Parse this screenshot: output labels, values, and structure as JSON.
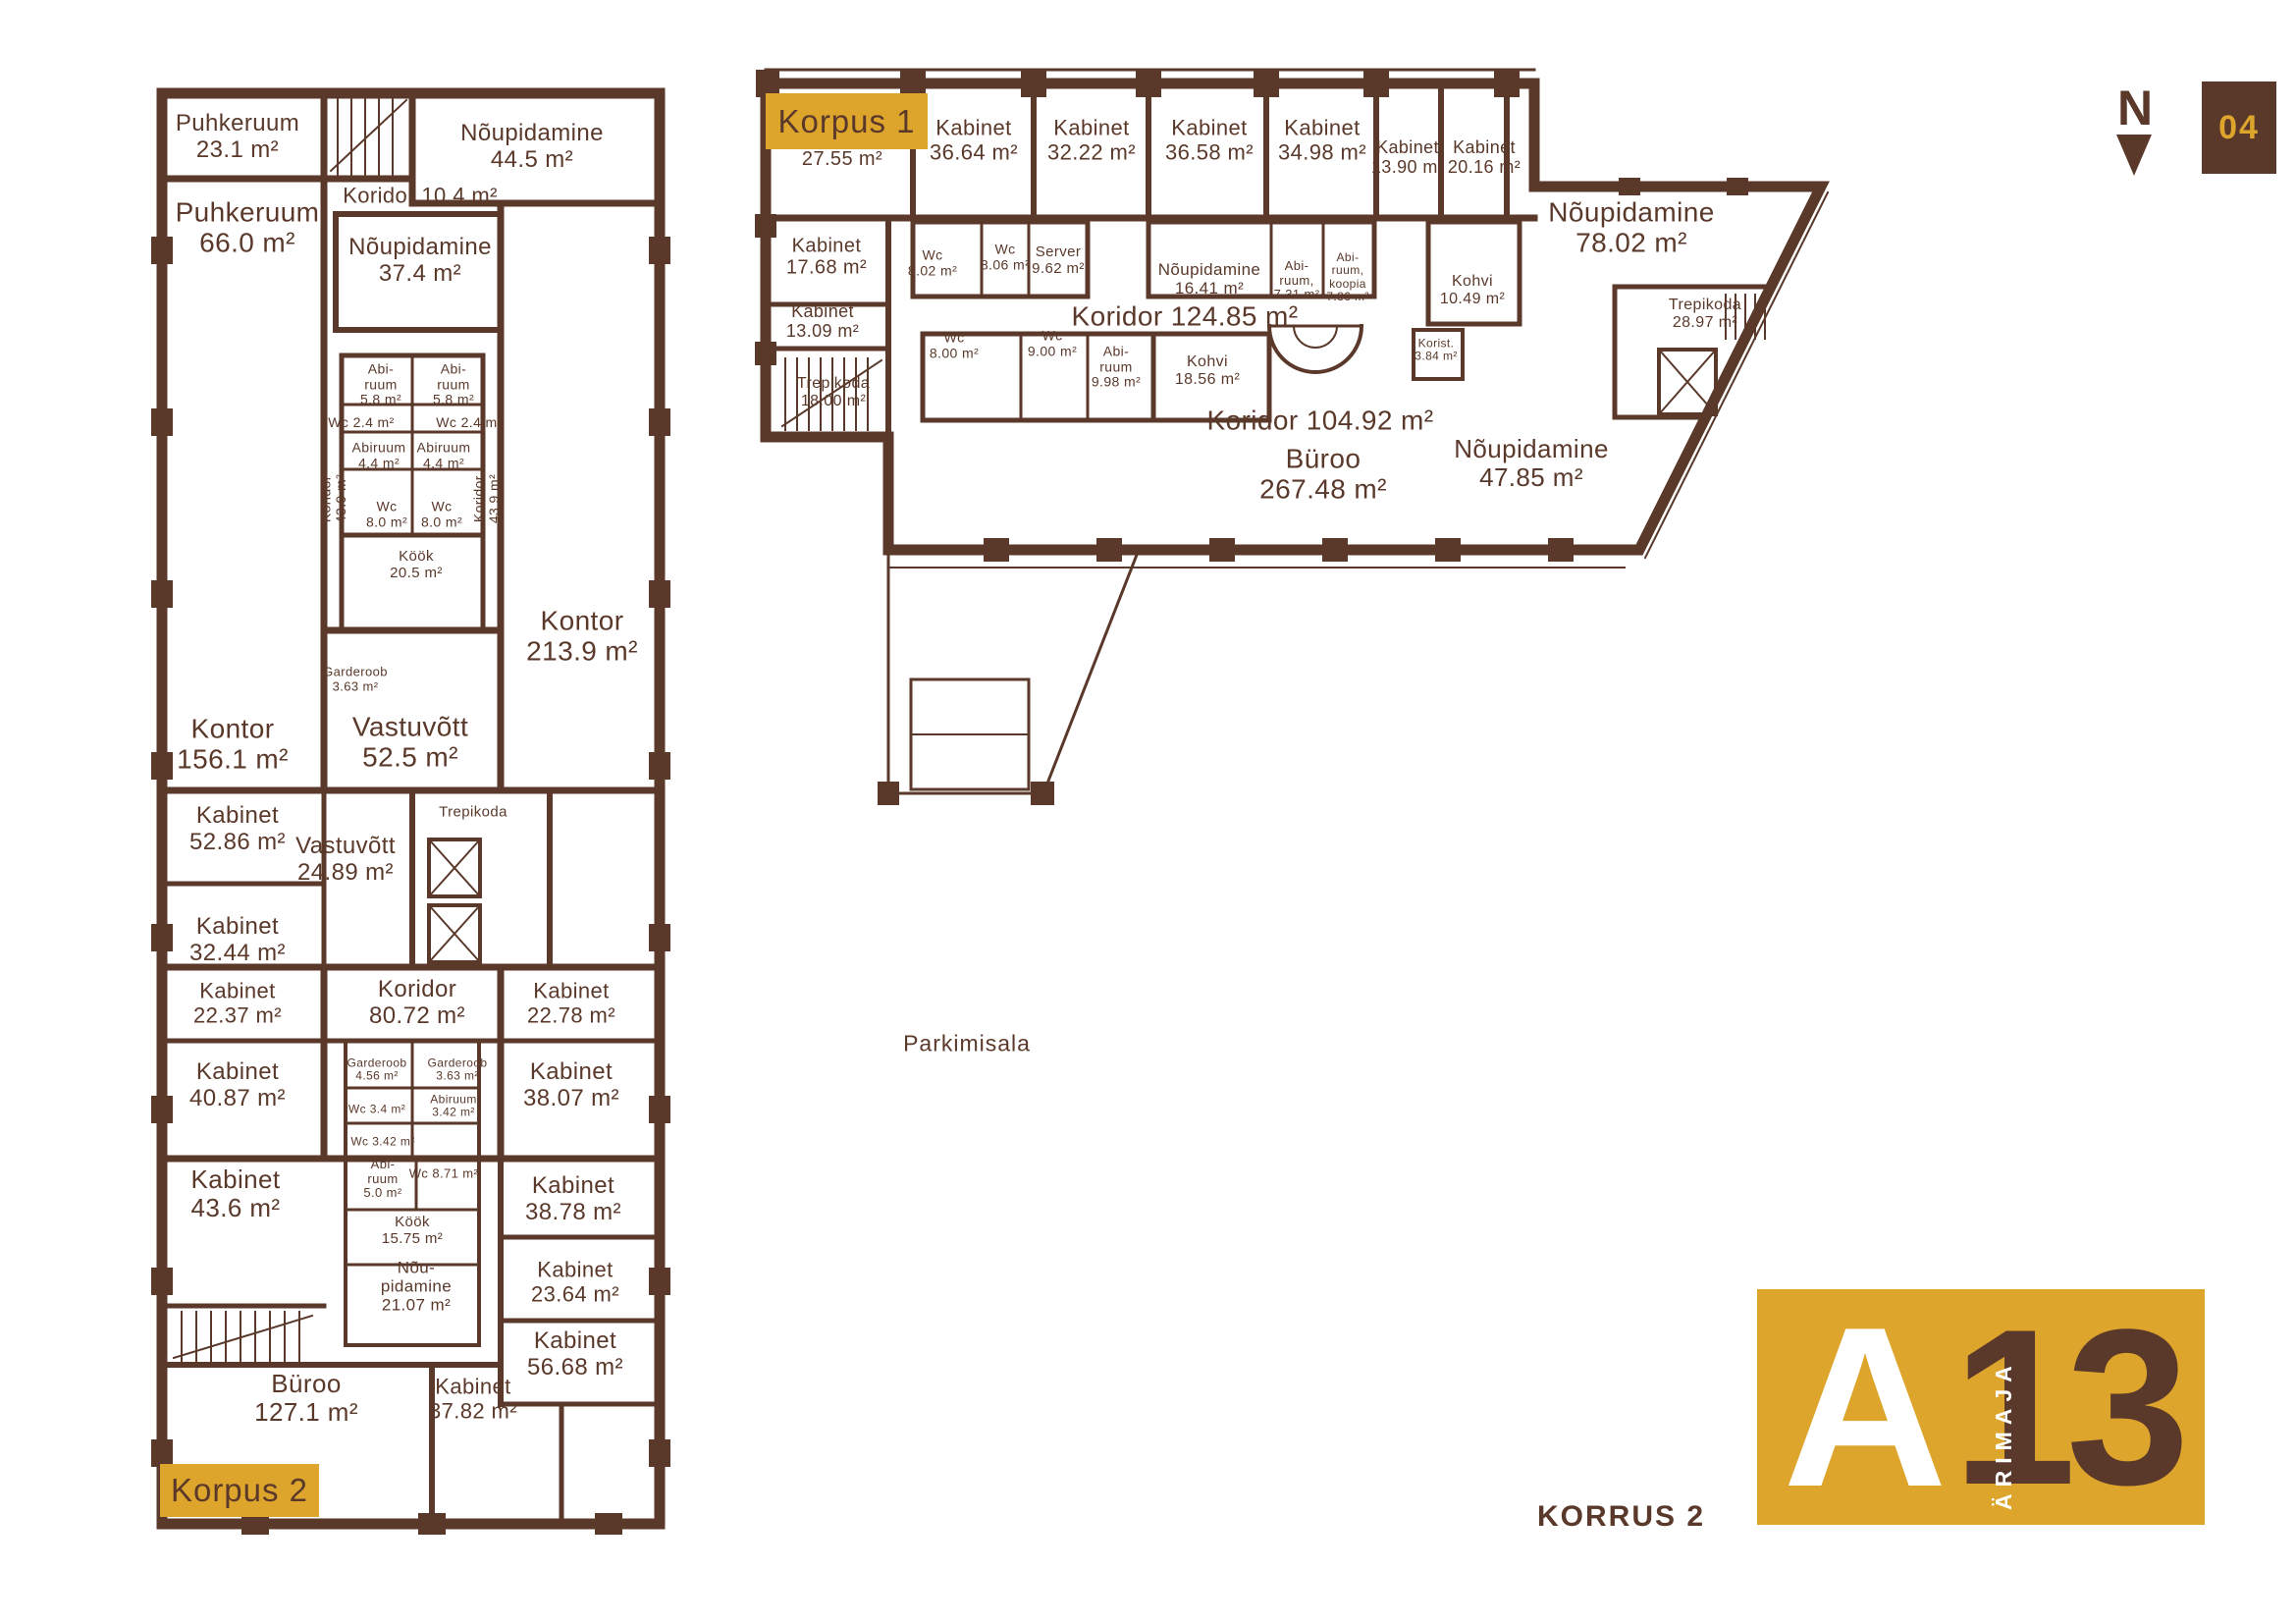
{
  "colors": {
    "brown": "#5A392B",
    "gold": "#DEA52C",
    "white": "#ffffff"
  },
  "header": {
    "compass_letter": "N",
    "sheet_number": "04"
  },
  "footer": {
    "floor_label": "KORRUS 2"
  },
  "site": {
    "parking_label": "Parkimisala"
  },
  "logo": {
    "letter_a": "A",
    "number": "13",
    "vertical_text": "ÄRIMAJA"
  },
  "korpus1": {
    "tag": "Korpus 1",
    "rooms": [
      {
        "name": "",
        "area": "27.55 m²"
      },
      {
        "name": "Kabinet",
        "area": "36.64 m²"
      },
      {
        "name": "Kabinet",
        "area": "32.22 m²"
      },
      {
        "name": "Kabinet",
        "area": "36.58 m²"
      },
      {
        "name": "Kabinet",
        "area": "34.98 m²"
      },
      {
        "name": "Kabinet",
        "area": "13.90 m²"
      },
      {
        "name": "Kabinet",
        "area": "20.16 m²"
      },
      {
        "name": "Nõupidamine",
        "area": "78.02 m²"
      },
      {
        "name": "Kabinet",
        "area": "17.68 m²"
      },
      {
        "name": "Wc",
        "area": "8.02 m²"
      },
      {
        "name": "Wc",
        "area": "8.06 m²"
      },
      {
        "name": "Server",
        "area": "9.62 m²"
      },
      {
        "name": "Nõupidamine",
        "area": "16.41 m²"
      },
      {
        "name": "Abi-\nruum,",
        "area": "7.31 m²"
      },
      {
        "name": "Abi-\nruum,\nkoopia",
        "area": "7.86 m²"
      },
      {
        "name": "Kohvi",
        "area": "10.49 m²"
      },
      {
        "name": "Trepikoda",
        "area": "28.97 m²"
      },
      {
        "name": "Koridor",
        "area": "124.85 m²"
      },
      {
        "name": "Kabinet",
        "area": "13.09 m²"
      },
      {
        "name": "Trepikoda",
        "area": "18.00 m²"
      },
      {
        "name": "Wc",
        "area": "8.00 m²"
      },
      {
        "name": "Wc",
        "area": "9.00 m²"
      },
      {
        "name": "Abi-\nruum",
        "area": "9.98 m²"
      },
      {
        "name": "Kohvi",
        "area": "18.56 m²"
      },
      {
        "name": "Korist.",
        "area": "3.84 m²"
      },
      {
        "name": "Koridor",
        "area": "104.92 m²"
      },
      {
        "name": "Büroo",
        "area": "267.48 m²"
      },
      {
        "name": "Nõupidamine",
        "area": "47.85 m²"
      }
    ]
  },
  "korpus2": {
    "tag": "Korpus 2",
    "rooms": [
      {
        "name": "Puhkeruum",
        "area": "23.1 m²"
      },
      {
        "name": "Nõupidamine",
        "area": "44.5 m²"
      },
      {
        "name": "Puhkeruum",
        "area": "66.0 m²"
      },
      {
        "name": "Koridor",
        "area": "10.4 m²"
      },
      {
        "name": "Nõupidamine",
        "area": "37.4 m²"
      },
      {
        "name": "Abi-\nruum",
        "area": "5.8 m²"
      },
      {
        "name": "Abi-\nruum",
        "area": "5.8 m²"
      },
      {
        "name": "Wc",
        "area": "2.4 m²"
      },
      {
        "name": "Wc",
        "area": "2.4 m²"
      },
      {
        "name": "Abiruum",
        "area": "4.4 m²"
      },
      {
        "name": "Abiruum",
        "area": "4.4 m²"
      },
      {
        "name": "Koridor",
        "area": "43.9 m²"
      },
      {
        "name": "Koridor",
        "area": "43.9 m²"
      },
      {
        "name": "Wc",
        "area": "8.0 m²"
      },
      {
        "name": "Wc",
        "area": "8.0 m²"
      },
      {
        "name": "Köök",
        "area": "20.5 m²"
      },
      {
        "name": "Kontor",
        "area": "213.9 m²"
      },
      {
        "name": "Garderoob",
        "area": "3.63 m²"
      },
      {
        "name": "Vastuvõtt",
        "area": "52.5 m²"
      },
      {
        "name": "Kontor",
        "area": "156.1 m²"
      },
      {
        "name": "Kabinet",
        "area": "52.86 m²"
      },
      {
        "name": "Vastuvõtt",
        "area": "24.89 m²"
      },
      {
        "name": "Trepikoda",
        "area": ""
      },
      {
        "name": "Kabinet",
        "area": "32.44 m²"
      },
      {
        "name": "Kabinet",
        "area": "22.37 m²"
      },
      {
        "name": "Koridor",
        "area": "80.72 m²"
      },
      {
        "name": "Kabinet",
        "area": "22.78 m²"
      },
      {
        "name": "Kabinet",
        "area": "40.87 m²"
      },
      {
        "name": "Garderoob",
        "area": "4.56 m²"
      },
      {
        "name": "Garderoob",
        "area": "3.63 m²"
      },
      {
        "name": "Wc",
        "area": "3.4 m²"
      },
      {
        "name": "Abiruum",
        "area": "3.42 m²"
      },
      {
        "name": "Wc",
        "area": "3.42 m²"
      },
      {
        "name": "Kabinet",
        "area": "38.07 m²"
      },
      {
        "name": "Kabinet",
        "area": "43.6 m²"
      },
      {
        "name": "Abi-\nruum",
        "area": "5.0 m²"
      },
      {
        "name": "Wc",
        "area": "8.71 m²"
      },
      {
        "name": "Köök",
        "area": "15.75 m²"
      },
      {
        "name": "Nõu-\npidamine",
        "area": "21.07 m²"
      },
      {
        "name": "Kabinet",
        "area": "38.78 m²"
      },
      {
        "name": "Kabinet",
        "area": "23.64 m²"
      },
      {
        "name": "Kabinet",
        "area": "56.68 m²"
      },
      {
        "name": "Büroo",
        "area": "127.1 m²"
      },
      {
        "name": "Kabinet",
        "area": "37.82 m²"
      }
    ]
  }
}
